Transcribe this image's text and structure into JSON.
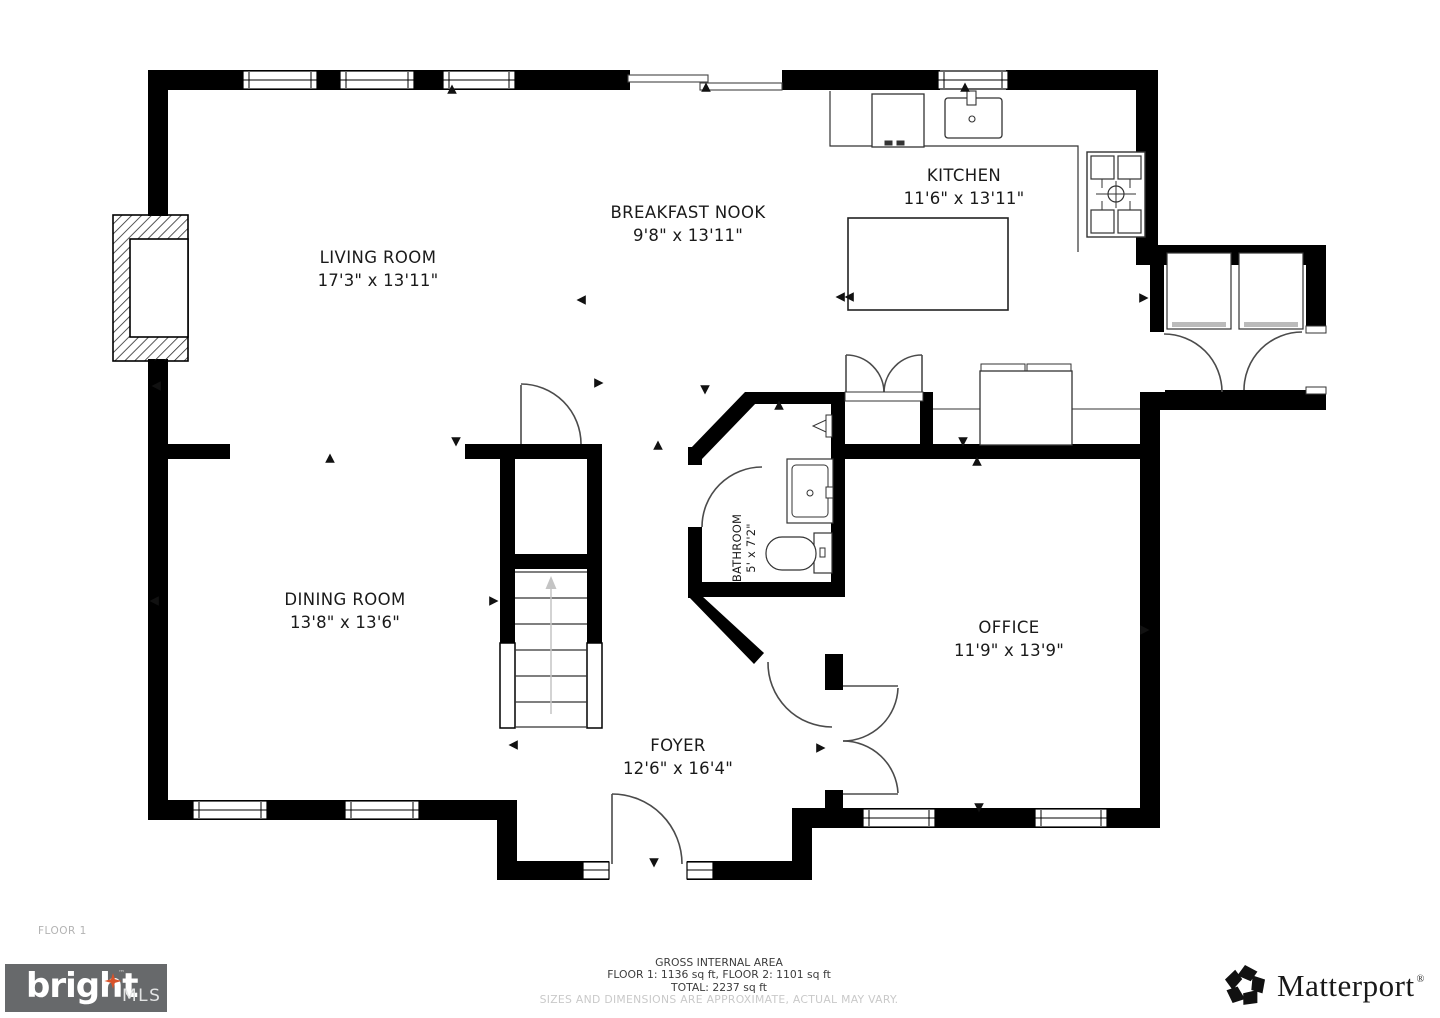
{
  "floor_label": "FLOOR 1",
  "rooms": [
    {
      "name": "LIVING ROOM",
      "dims": "17'3\" x 13'11\""
    },
    {
      "name": "BREAKFAST NOOK",
      "dims": "9'8\" x 13'11\""
    },
    {
      "name": "KITCHEN",
      "dims": "11'6\" x 13'11\""
    },
    {
      "name": "DINING ROOM",
      "dims": "13'8\" x 13'6\""
    },
    {
      "name": "BATHROOM",
      "dims": "5' x 7'2\""
    },
    {
      "name": "OFFICE",
      "dims": "11'9\" x 13'9\""
    },
    {
      "name": "FOYER",
      "dims": "12'6\" x 16'4\""
    }
  ],
  "footer": {
    "area_title": "GROSS INTERNAL AREA",
    "area_floors": "FLOOR 1: 1136 sq ft, FLOOR 2: 1101 sq ft",
    "area_total": "TOTAL: 2237 sq ft",
    "disclaimer": "SIZES AND DIMENSIONS ARE APPROXIMATE, ACTUAL MAY VARY."
  },
  "logos": {
    "bright_text": "bright",
    "bright_tm": "™",
    "bright_suffix": "MLS",
    "matterport_text": "Matterport",
    "matterport_reg": "®"
  },
  "colors": {
    "wall": "#000000",
    "door_stroke": "#4b4b4b",
    "fixture_stroke": "#333333",
    "bright_bg": "#67696b",
    "bright_star": "#d8532a",
    "muted_text": "#c9c9c9",
    "footer_text": "#3c3c3c"
  }
}
